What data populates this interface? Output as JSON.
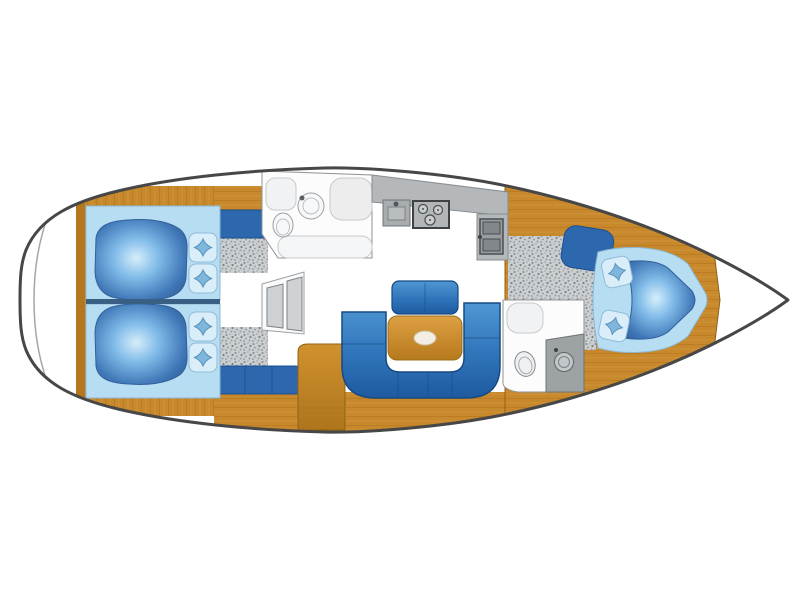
{
  "image": {
    "kind": "yacht-interior-deck-plan",
    "orientation": "bow-right",
    "background": "#ffffff"
  },
  "colors": {
    "hull_outline": "#474747",
    "transom_line": "#a3a7aa",
    "wood": "#c8882c",
    "wood_dark": "#a8701d",
    "counter_gray": "#b4b8bb",
    "appliance_gray": "#989da0",
    "carpet_gray": "#cbcfd2",
    "upholstery": "#2d68ae",
    "sofa_blue": "#2f74ba",
    "bed_linen": "#b7ddf2",
    "duvet_blue": "#2d62a8",
    "pillow_blue": "#7fb6dc",
    "room_white": "#fcfcfc",
    "bed_seam": "#3a5f85",
    "fixture_outline": "#9aa0a3"
  },
  "areas": [
    {
      "id": "stern-transom"
    },
    {
      "id": "aft-cabin-port"
    },
    {
      "id": "aft-cabin-starboard"
    },
    {
      "id": "companionway-steps"
    },
    {
      "id": "aft-head"
    },
    {
      "id": "galley"
    },
    {
      "id": "salon"
    },
    {
      "id": "nav-station"
    },
    {
      "id": "forward-head"
    },
    {
      "id": "forward-cabin"
    },
    {
      "id": "bow"
    }
  ],
  "fixtures": [
    {
      "id": "aft-head-toilet"
    },
    {
      "id": "aft-head-washbasin"
    },
    {
      "id": "aft-head-shower"
    },
    {
      "id": "galley-sink"
    },
    {
      "id": "galley-stove-3-burner"
    },
    {
      "id": "galley-double-sink"
    },
    {
      "id": "salon-u-sofa"
    },
    {
      "id": "salon-table"
    },
    {
      "id": "salon-bench"
    },
    {
      "id": "nav-desk"
    },
    {
      "id": "nav-bench"
    },
    {
      "id": "forward-head-toilet"
    },
    {
      "id": "forward-head-washbasin"
    },
    {
      "id": "forward-v-berth"
    },
    {
      "id": "forward-seat"
    }
  ]
}
